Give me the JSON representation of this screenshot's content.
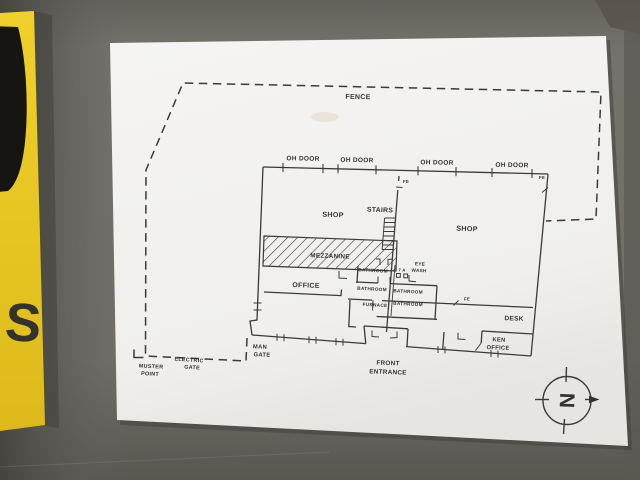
{
  "photo": {
    "subject": "Facility floor plan sheet taped to a gray wall",
    "colors": {
      "wall_gray": "#6f6d66",
      "wall_dark": "#55544d",
      "paper_white": "#f2f1ee",
      "sign_yellow": "#ecc922",
      "ink": "#34322f"
    }
  },
  "wall_sign": {
    "visible_letter": "S"
  },
  "plan": {
    "site": {
      "fence": "FENCE",
      "muster_1": "MUSTER",
      "muster_2": "POINT",
      "electric_1": "ELECTRIC",
      "electric_2": "GATE",
      "man_1": "MAN",
      "man_2": "GATE"
    },
    "rooms": {
      "shop": "SHOP",
      "stairs": "STAIRS",
      "mezzanine": "MEZZANINE",
      "office": "OFFICE",
      "bathroom": "BATHROOM",
      "furnace": "FURNACE",
      "desk": "DESK",
      "ken_1": "KEN",
      "ken_2": "OFFICE",
      "front_1": "FRONT",
      "front_2": "ENTRANCE"
    },
    "safety": {
      "fe": "FE",
      "eye_1": "EYE",
      "eye_2": "WASH",
      "first_aid": "7 A"
    },
    "doors": {
      "oh_door": "OH DOOR"
    },
    "compass": {
      "north": "N"
    }
  }
}
